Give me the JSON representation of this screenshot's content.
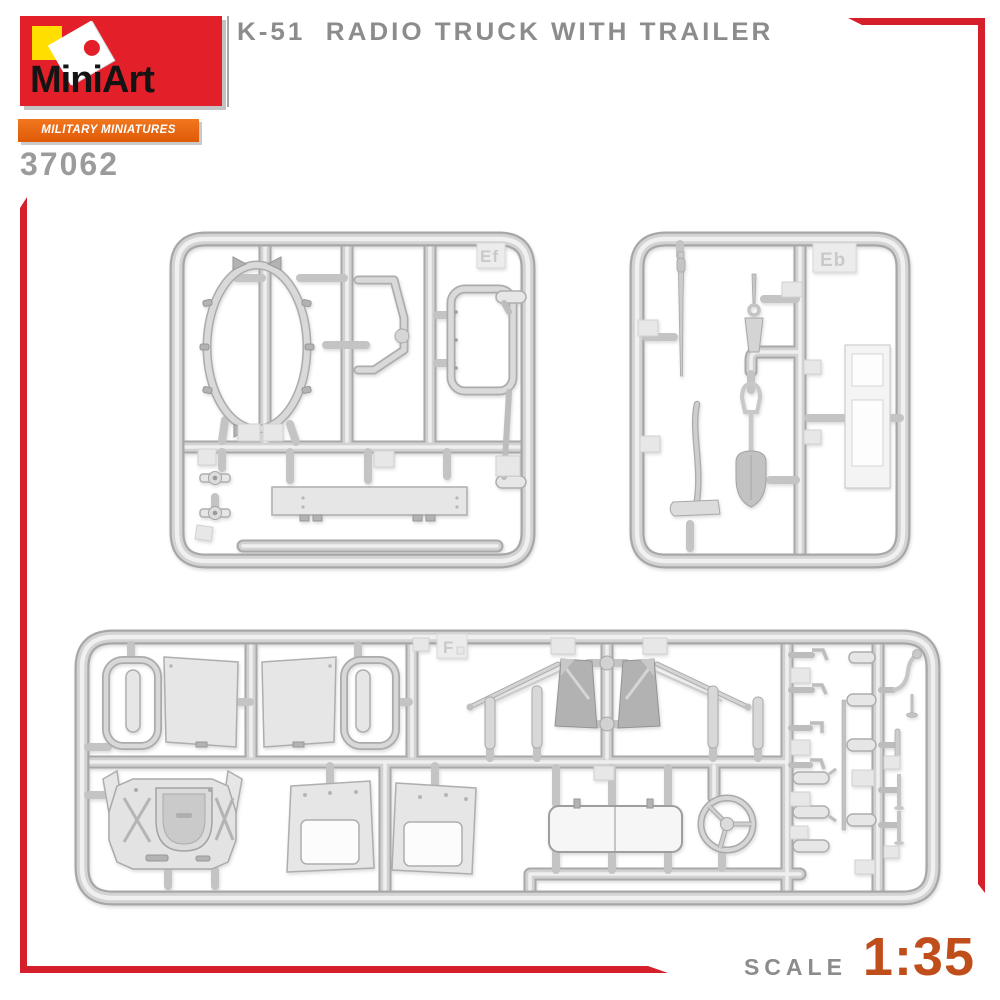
{
  "header": {
    "brand": {
      "name": "MiniArt",
      "series": "MILITARY MINIATURES SERIES"
    },
    "kit_number": "37062",
    "title": "K-51  RADIO TRUCK WITH TRAILER"
  },
  "footer": {
    "scale_label": "SCALE",
    "scale_value": "1:35"
  },
  "sprues": [
    {
      "label": "Ef",
      "contents": "canvas bows, brackets, seat frame, running board, pulleys"
    },
    {
      "label": "Eb",
      "contents": "mast pole, pick, shovel, axe, trailer frame"
    },
    {
      "label": "F",
      "contents": "cab doors, door frames, cab floor, windshield flaps, bench seat, steering wheel, levers"
    }
  ],
  "colors": {
    "accent_red": "#D51F2B",
    "logo_red": "#E31F2A",
    "logo_yellow": "#FFDE00",
    "banner_orange": "#EC6616",
    "scale_orange": "#C04E1B",
    "text_gray": "#8C8C8C",
    "sprue_gray": "#D3D3D3"
  }
}
